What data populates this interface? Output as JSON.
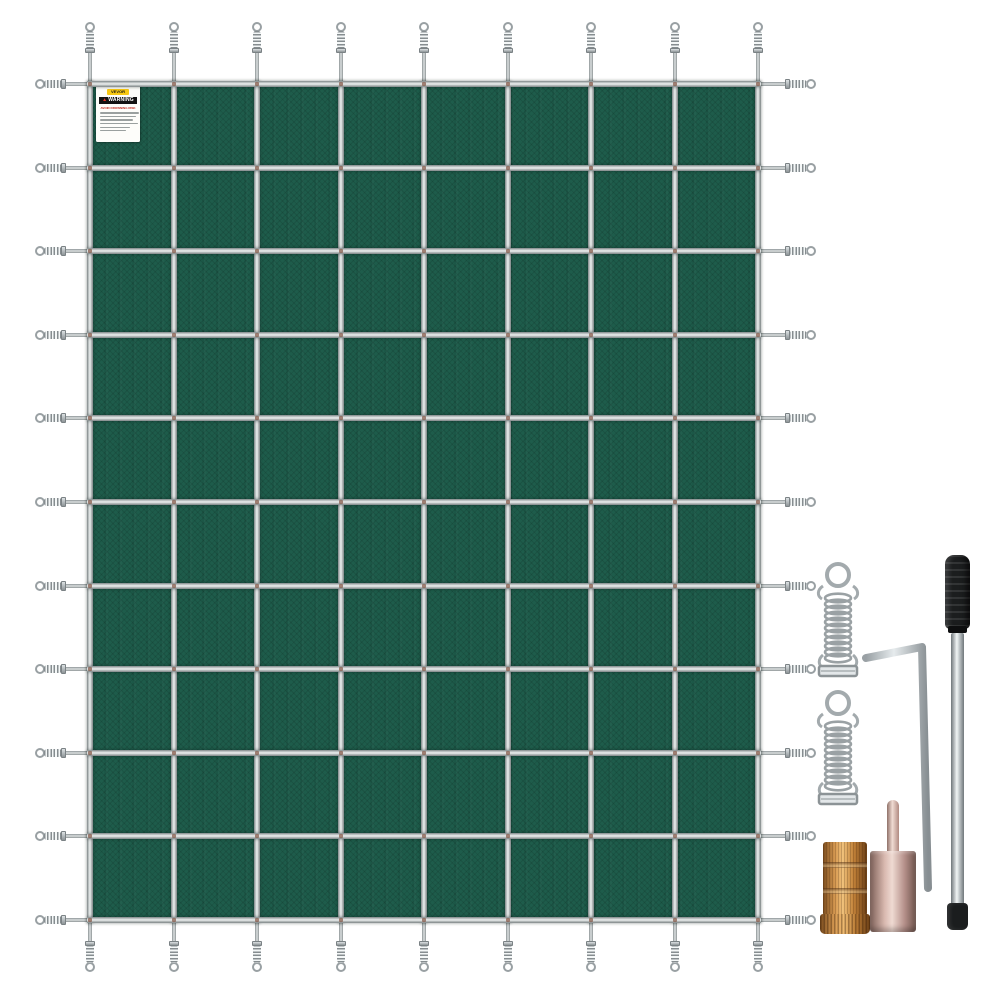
{
  "product": {
    "type": "rectangular green mesh pool safety cover with strap grid and perimeter springs",
    "label": {
      "brand": "VEVOR",
      "warning_title": "WARNING",
      "warning_icon": "warning-triangle-icon",
      "notice": "AVOID DROWNING RISK",
      "body_line_count": 6
    },
    "grid": {
      "columns": 8,
      "rows": 10,
      "vertical_straps": 9,
      "horizontal_straps": 11,
      "perimeter_springs": 40
    },
    "colors": {
      "cover_green": "#1e5c4b",
      "strap_gray": "#9aa1a3",
      "strap_highlight": "#eef1f1",
      "stitch_red": "#7c4a38",
      "steel": "#aab1b4",
      "steel_dark": "#8c9396",
      "brass": "#c98a45",
      "rose_metal": "#c8a69d",
      "handle_black": "#1b1d1e",
      "label_yellow": "#f7c812",
      "warning_red": "#c0281c",
      "label_bg": "#fdfdfa",
      "background": "#ffffff"
    }
  },
  "accessories": {
    "items": [
      {
        "id": "spring-1",
        "kind": "stainless-steel-spring"
      },
      {
        "id": "spring-2",
        "kind": "stainless-steel-spring"
      },
      {
        "id": "hex-key",
        "kind": "hex-key-tool"
      },
      {
        "id": "installation-rod",
        "kind": "anchor-installation-rod"
      },
      {
        "id": "brass-anchor",
        "kind": "brass-concrete-anchor"
      },
      {
        "id": "anchor-tool",
        "kind": "anchor-with-stem"
      }
    ]
  }
}
